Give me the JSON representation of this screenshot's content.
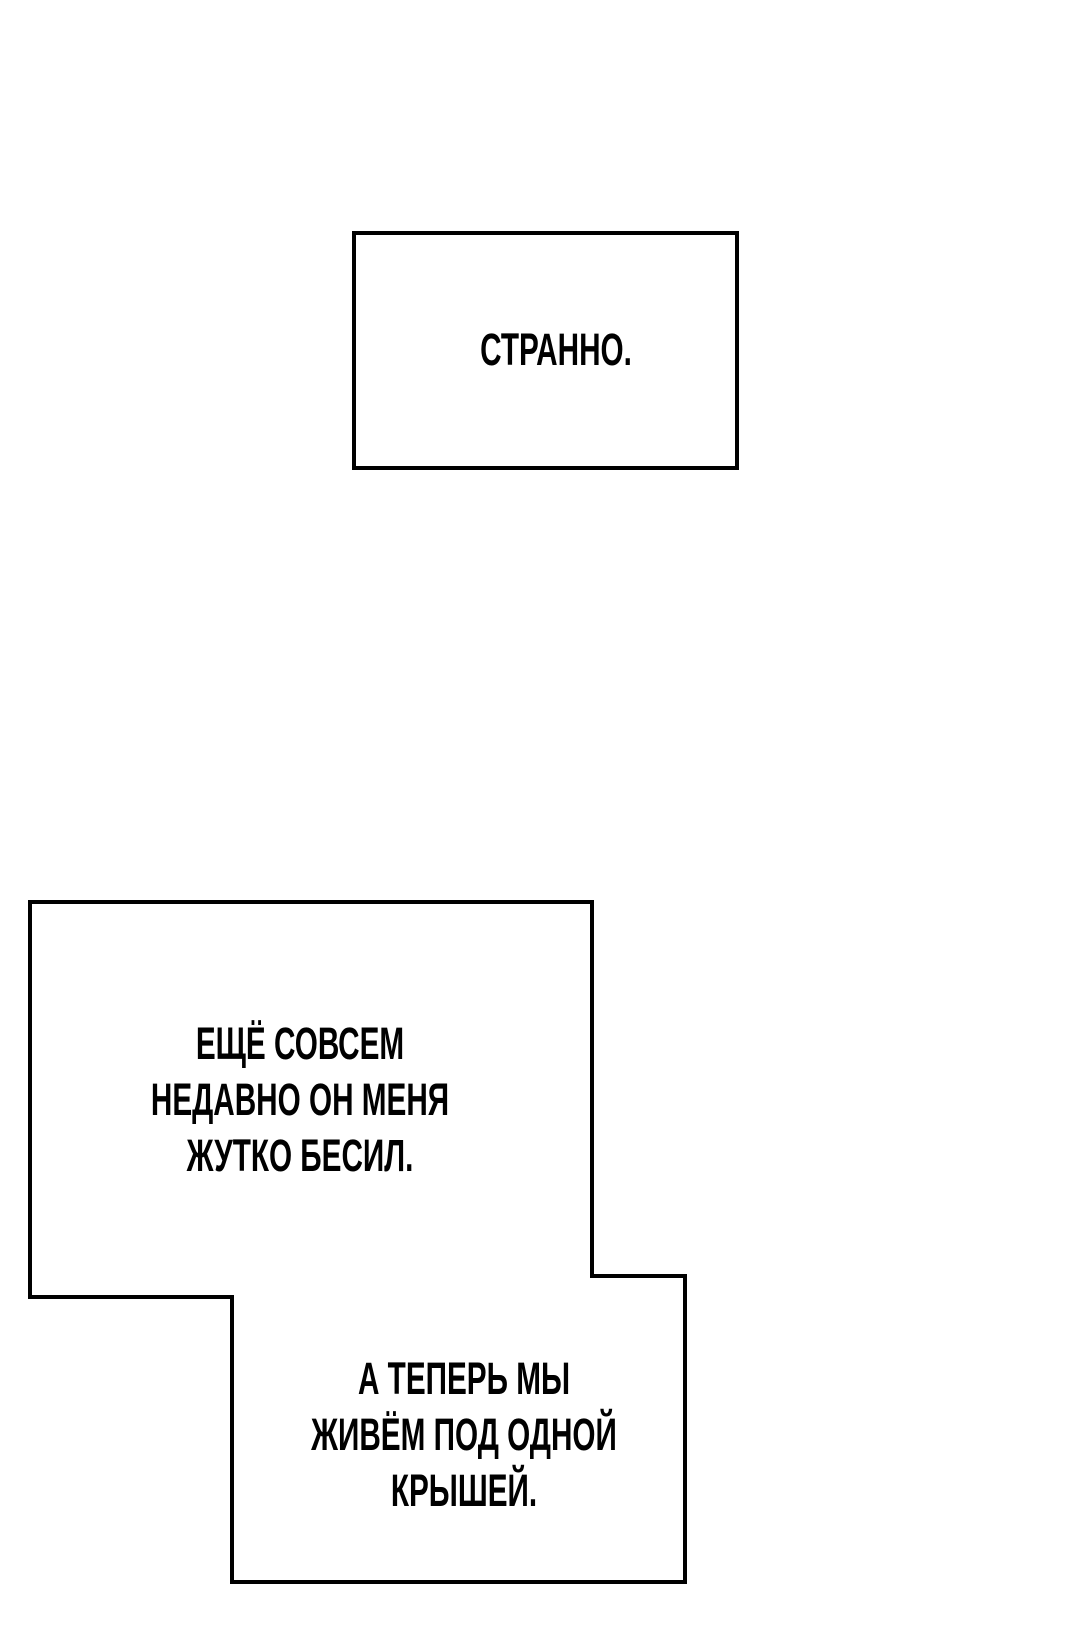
{
  "page": {
    "kind": "comic-page",
    "background_color": "#ffffff"
  },
  "colors": {
    "panel_fill": "#ffffff",
    "panel_border": "#000000",
    "text": "#000000"
  },
  "panels": [
    {
      "name": "narration-box-strange",
      "shape": "rectangle",
      "text": "СТРАННО."
    },
    {
      "name": "narration-box-recently",
      "shape": "rectangle-merged-upper-left",
      "text": "ЕЩЁ СОВСЕМ\nНЕДАВНО ОН МЕНЯ\nЖУТКО БЕСИЛ."
    },
    {
      "name": "narration-box-same-roof",
      "shape": "rectangle-merged-lower-right",
      "text": "А ТЕПЕРЬ МЫ\nЖИВЁМ ПОД ОДНОЙ\nКРЫШЕЙ."
    }
  ]
}
